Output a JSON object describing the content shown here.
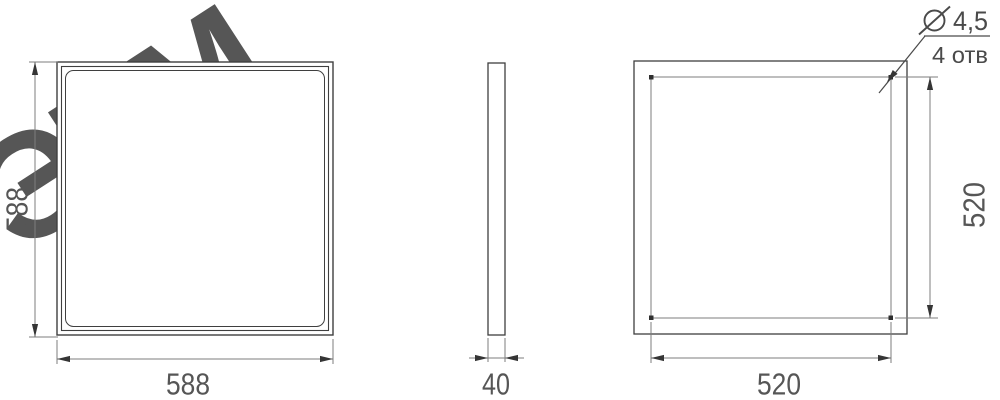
{
  "watermark": {
    "text": "ЭТМ"
  },
  "front_view": {
    "description": "front view of square panel with beveled frame",
    "width": "588",
    "height": "588"
  },
  "side_view": {
    "description": "side profile view",
    "thickness": "40"
  },
  "back_view": {
    "description": "back view with 4 mounting holes",
    "hole_spacing_width": "520",
    "hole_spacing_height": "520",
    "hole_diameter": "4,5",
    "hole_count": "4 отв"
  },
  "icons": {
    "diameter_symbol": "circle-with-slash"
  },
  "colors": {
    "outline": "#3f3f3f",
    "dimension_line": "#7d7d7d",
    "dimension_text": "#565656",
    "arrow": "#353535",
    "watermark_hatch": "#d8d8d8",
    "background": "#ffffff"
  }
}
